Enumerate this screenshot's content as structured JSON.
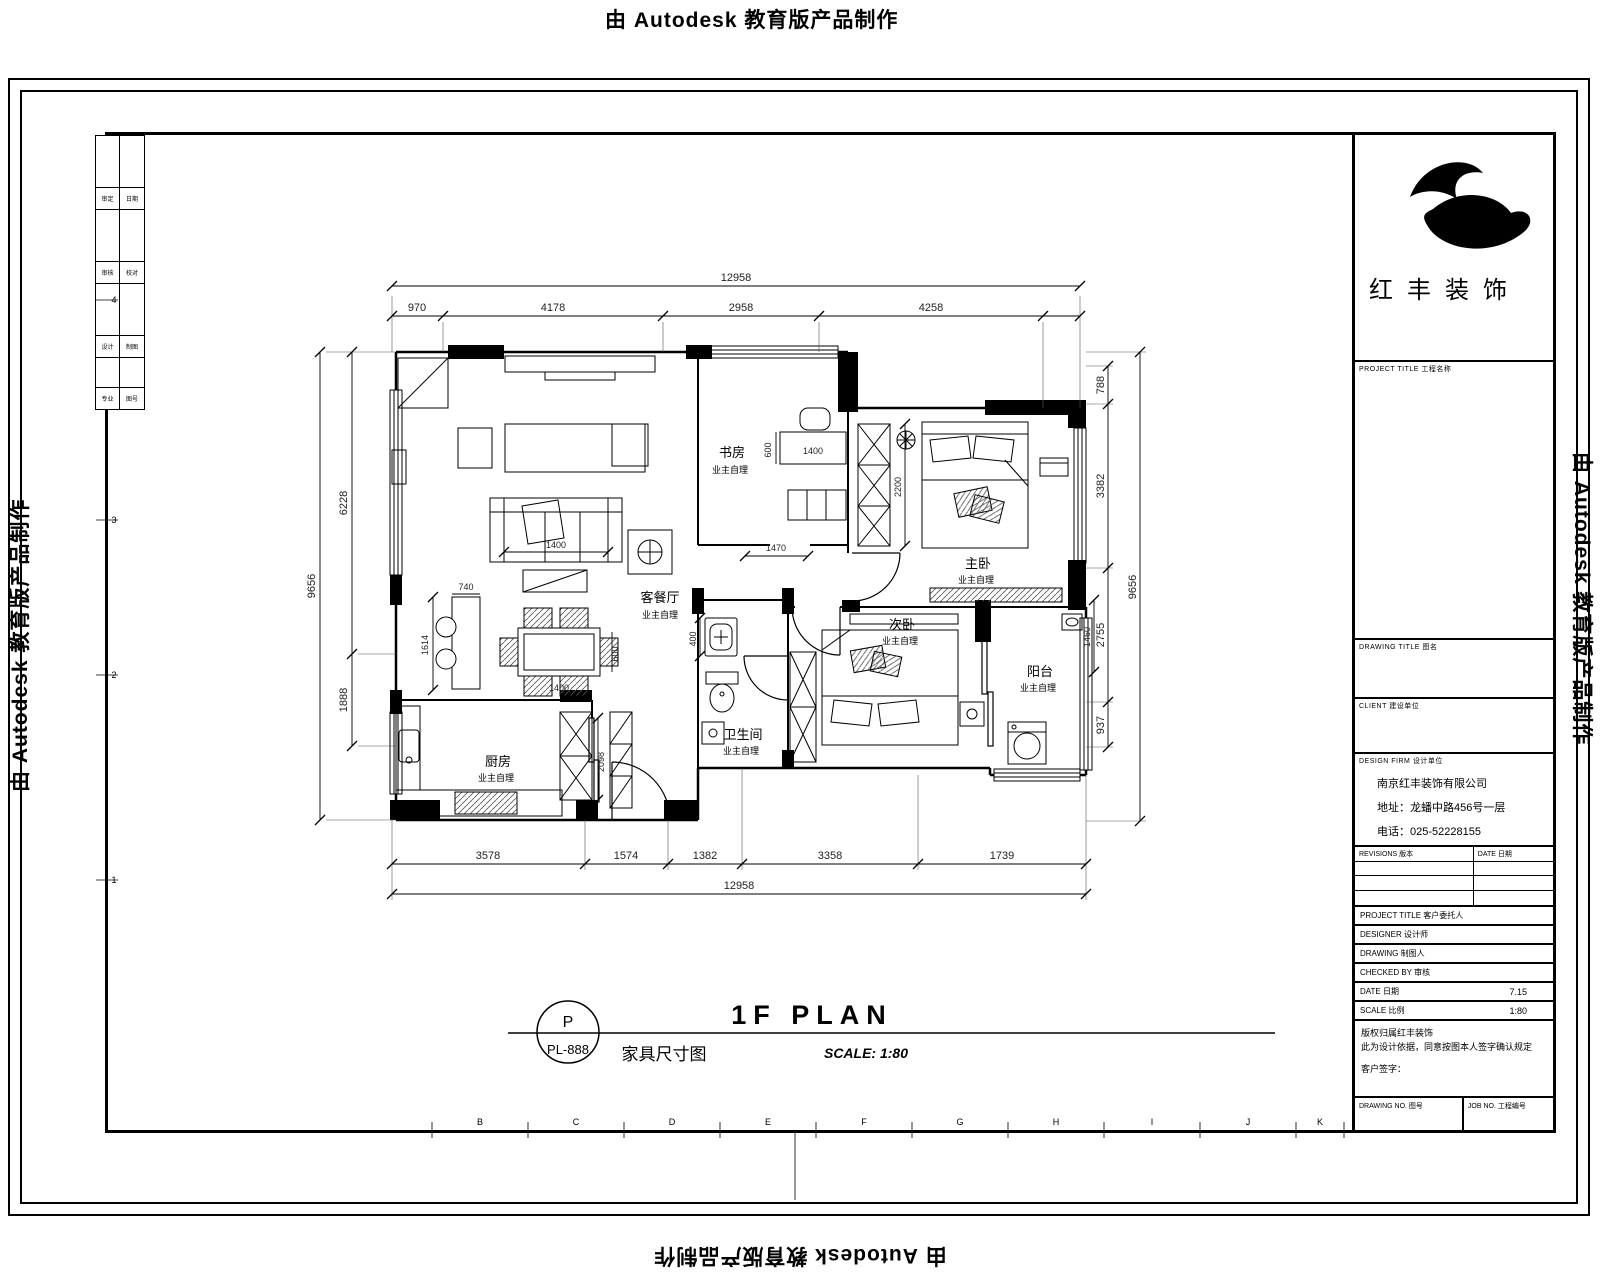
{
  "watermark": {
    "text": "由 Autodesk 教育版产品制作"
  },
  "stamp": {
    "circle_top": "P",
    "circle_bottom": "PL-888",
    "title_en": "1F PLAN",
    "title_cn": "家具尺寸图",
    "scale": "SCALE: 1:80"
  },
  "rooms": {
    "living": {
      "name": "客餐厅",
      "note": "业主自理"
    },
    "study": {
      "name": "书房",
      "note": "业主自理"
    },
    "master": {
      "name": "主卧",
      "note": "业主自理"
    },
    "second": {
      "name": "次卧",
      "note": "业主自理"
    },
    "balcony": {
      "name": "阳台",
      "note": "业主自理"
    },
    "bath": {
      "name": "卫生间",
      "note": "业主自理"
    },
    "kitchen": {
      "name": "厨房",
      "note": "业主自理"
    }
  },
  "dims": {
    "top": {
      "total": "12958",
      "s1": "970",
      "s2": "4178",
      "s3": "2958",
      "s4": "4258"
    },
    "bottom": {
      "total": "12958",
      "s1": "3578",
      "s2": "1574",
      "s3": "1382",
      "s4": "3358",
      "s5": "1739"
    },
    "left": {
      "total": "9656",
      "s1": "6228",
      "s2": "1888"
    },
    "right": {
      "total": "9656",
      "s1": "788",
      "s2": "3382",
      "s3": "2755",
      "s4": "937",
      "inner": "1460"
    },
    "interior": {
      "sofa": "1400",
      "dining": "1400",
      "dining_side": "600",
      "bar_w": "740",
      "bar_h": "1614",
      "desk": "1400",
      "desk_side": "600",
      "corridor": "1470",
      "bed": "2200",
      "sink": "400",
      "kitchen": "2098"
    }
  },
  "grid": {
    "letters": [
      "B",
      "C",
      "D",
      "E",
      "F",
      "G",
      "H",
      "I",
      "J",
      "K"
    ],
    "numbers": [
      "4",
      "3",
      "2",
      "1"
    ]
  },
  "signoff": {
    "rows": [
      [
        "审定",
        "日期"
      ],
      [
        "审核",
        "校对"
      ],
      [
        "设计",
        "制图"
      ],
      [
        "专业",
        "图号"
      ]
    ]
  },
  "titleblock": {
    "logo_text": "红丰装饰",
    "project_label": "PROJECT TITLE  工程名称",
    "drawing_label": "DRAWING TITLE  图名",
    "client_label": "CLIENT  建设单位",
    "firm_label": "DESIGN FIRM  设计单位",
    "company_name": "南京红丰装饰有限公司",
    "company_address": "地址：龙蟠中路456号一层",
    "company_phone": "电话：025-52228155",
    "rev_label": "REVISIONS  版本",
    "rev_date_label": "DATE  日期",
    "customer_label": "PROJECT TITLE  客户委托人",
    "designer_label": "DESIGNER  设计师",
    "drafter_label": "DRAWING  制图人",
    "checker_label": "CHECKED BY  审核",
    "date_label": "DATE  日期",
    "date_value": "7.15",
    "scale_label": "SCALE  比例",
    "scale_value": "1:80",
    "note_line1": "版权归属红丰装饰",
    "note_line2": "此为设计依据，同意按图本人签字确认规定",
    "note_line3": "客户签字：",
    "drawing_no_label": "DRAWING NO.  图号",
    "job_no_label": "JOB NO.  工程编号"
  }
}
